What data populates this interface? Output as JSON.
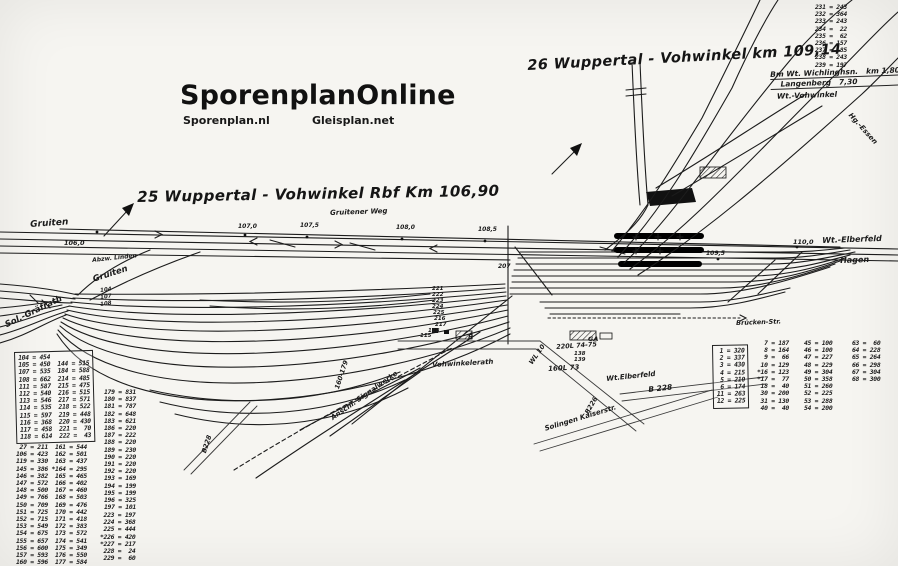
{
  "branding": {
    "title": "SporenplanOnline",
    "site_left": "Sporenplan.nl",
    "site_right": "Gleisplan.net"
  },
  "headings": {
    "plan25": "25 Wuppertal - Vohwinkel Rbf   Km 106,90",
    "plan26": "26 Wuppertal - Vohwinkel  km 109,14"
  },
  "bm_note": {
    "line1": "Bm Wt. Wichlinghsn.",
    "km1": "km 1,80",
    "line2": "Langenberg",
    "km2": "7,30",
    "line3": "Wt.-Vohwinkel"
  },
  "labels": {
    "gruiten_top": "Gruiten",
    "km_106": "106,0",
    "abzw_linden": "Abzw. Linden",
    "gruiten_mid": "Gruiten",
    "sol_graefrath": "Sol.-Gräfrath",
    "gruitener_weg": "Gruitener Weg",
    "km_107": "107,0",
    "km_107_5": "107,5",
    "km_108": "108,0",
    "km_108_5": "108,5",
    "km_109_5": "109,5",
    "km_110": "110,0",
    "wt_elberfeld_right": "Wt.-Elberfeld",
    "hagen": "Hagen",
    "vohwinkelerath": "Vohwinkelerath",
    "wl_10": "WL 10",
    "l_220": "220L 74-75",
    "ga": "GA",
    "n_138": "138",
    "n_139": "139",
    "l_160": "160L 73",
    "wt_elberfeld_mid": "Wt.Elberfeld",
    "b_228_right": "B 228",
    "solingen_kaiserstr": "Solingen  Kaiserstr.",
    "b_226": "B226",
    "b_228_left": "B228",
    "anschl_signalwerke": "Anschl. Signalwerke",
    "n_160_179": "160-179",
    "bruecken_str": "Brücken-Str.",
    "hg_essen": "Hg.-Essen",
    "r_mark": "R",
    "t_104": "104",
    "t_107": "107",
    "t_108": "108",
    "t_207": "207",
    "t_221": "221",
    "t_222": "222",
    "t_223": "223",
    "t_224": "224",
    "t_225": "225",
    "t_216": "216",
    "t_217": "217",
    "t_118": "118",
    "t_115": "115"
  },
  "tables": {
    "top_right": [
      "231 = 243",
      "232 = 364",
      "233 = 243",
      "234 =  22",
      "235 =  62",
      "236 = 157",
      "237 =  85",
      "238 = 243",
      "239 = 197"
    ],
    "left_box": [
      "104 = 454",
      "105 = 450  144 = 515",
      "107 = 535  184 = 588",
      "108 = 662  214 = 485",
      "111 = 587  215 = 475",
      "112 = 540  216 = 515",
      "113 = 546  217 = 571",
      "114 = 535  218 = 522",
      "115 = 597  219 = 448",
      "116 = 368  220 = 430",
      "117 = 458  221 =  70",
      "118 = 614  222 =  43"
    ],
    "left_col": [
      " 27 = 211  161 = 544",
      "106 = 423  162 = 501",
      "119 = 330  163 = 437",
      "145 = 386 *164 = 295",
      "146 = 382  165 = 465",
      "147 = 572  166 = 402",
      "148 = 500  167 = 460",
      "149 = 766  168 = 503",
      "150 = 709  169 = 476",
      "151 = 725  170 = 442",
      "152 = 715  171 = 418",
      "153 = 549  172 = 383",
      "154 = 675  173 = 572",
      "155 = 657  174 = 541",
      "156 = 600  175 = 349",
      "157 = 593  176 = 550",
      "160 = 596  177 = 584"
    ],
    "mid_col_a": [
      "179 = 831",
      "180 = 837",
      "181 = 787",
      "182 = 648",
      "183 = 621",
      "186 = 220",
      "187 = 222",
      "188 = 220",
      "189 = 230",
      "190 = 220",
      "191 = 220",
      "192 = 220",
      "193 = 169",
      "194 = 199",
      "195 = 199",
      "196 = 325",
      "197 = 101"
    ],
    "mid_col_b": [
      " 223 = 197",
      " 224 = 368",
      " 225 = 444",
      "*226 = 420",
      "*227 = 217",
      " 228 =  24",
      " 229 =  60"
    ],
    "right_box": [
      " 1 = 320",
      " 2 = 337",
      " 3 = 430",
      " 4 = 215",
      " 5 = 210",
      " 6 = 174",
      "11 = 263",
      "12 = 225"
    ],
    "right_col_1": [
      "  7 = 187",
      "  8 = 164",
      "  9 =  66",
      " 10 = 129",
      "*16 = 123",
      "*17 =  77",
      " 18 =  40",
      " 30 = 200",
      " 31 = 130",
      " 40 =  40"
    ],
    "right_col_2": [
      "45 = 100",
      "46 = 100",
      "47 = 227",
      "48 = 229",
      "49 = 304",
      "50 = 358",
      "51 = 260",
      "52 = 225",
      "53 = 288",
      "54 = 200"
    ],
    "right_col_3": [
      "63 =  60",
      "64 = 228",
      "65 = 264",
      "66 = 298",
      "67 = 304",
      "68 = 300"
    ]
  },
  "colors": {
    "ink": "#1c1c1c",
    "paper": "#f6f5f1"
  }
}
